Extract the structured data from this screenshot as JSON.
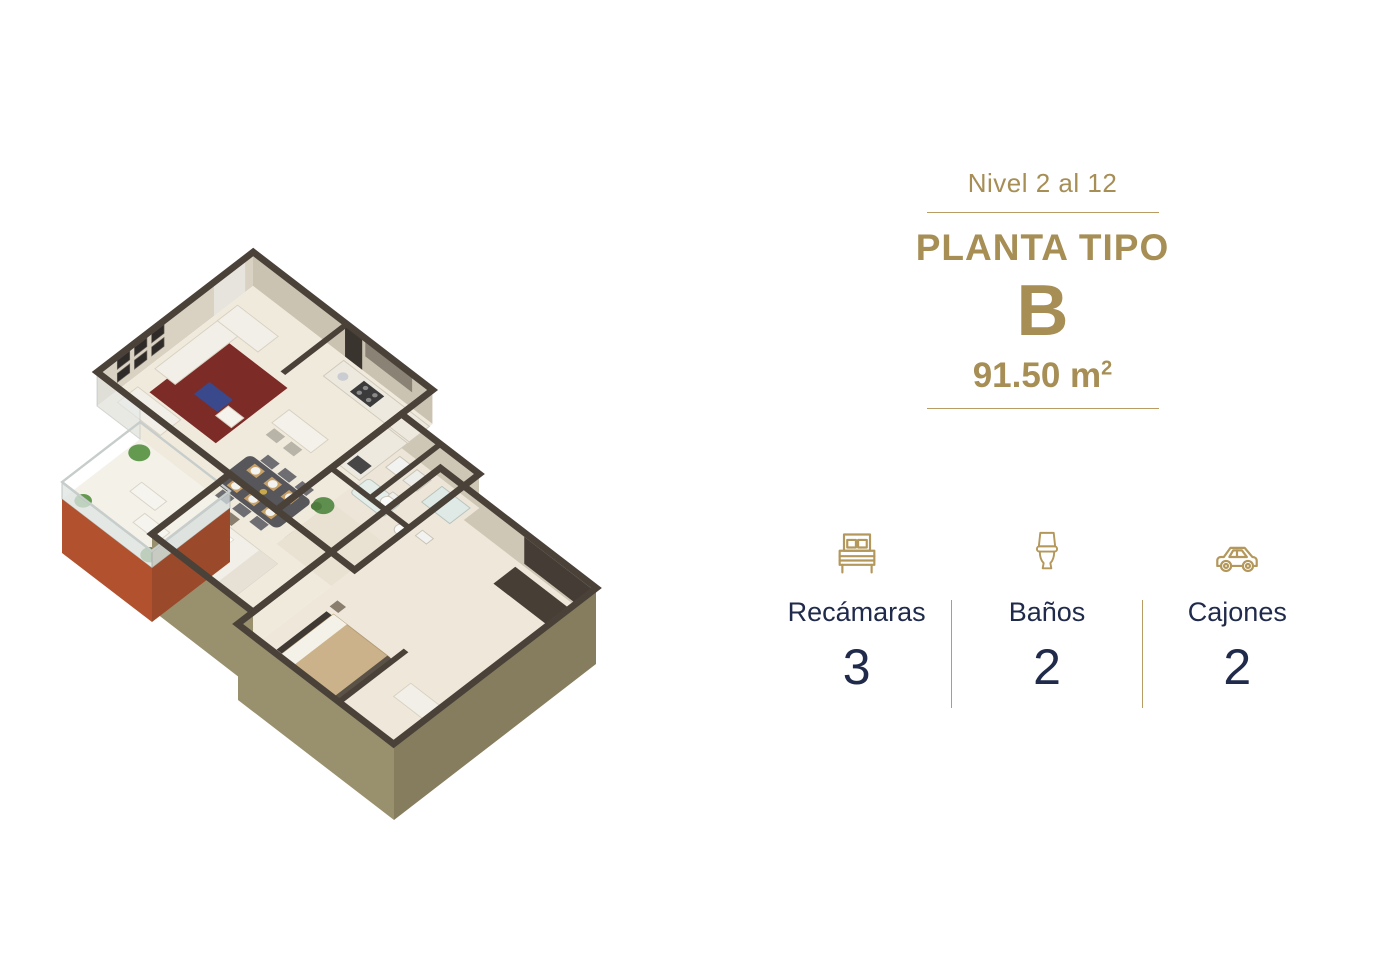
{
  "panel": {
    "level_label": "Nivel 2 al 12",
    "plan_type_label": "PLANTA TIPO",
    "plan_letter": "B",
    "area_text": "91.50 m",
    "area_superscript": "2",
    "accent_gold": "#A68E55",
    "divider_gold": "#B99C63",
    "text_navy": "#202B4B",
    "icon_gold": "#B4975A"
  },
  "stats": [
    {
      "icon": "bed-icon",
      "label": "Recámaras",
      "value": "3"
    },
    {
      "icon": "toilet-icon",
      "label": "Baños",
      "value": "2"
    },
    {
      "icon": "car-icon",
      "label": "Cajones",
      "value": "2"
    }
  ],
  "floorplan": {
    "kind": "isometric-3d-apartment-plan",
    "palette": {
      "wall_cap": "#4A4139",
      "interior_wall": "#D9D2C2",
      "exterior_khaki": "#99906E",
      "exterior_khaki_dark": "#867D5F",
      "floor_cream": "#F0EADD",
      "balcony_terracotta": "#B2512E",
      "balcony_terracotta_dark": "#9A4A2B",
      "rug_red": "#7D2B27",
      "ottoman_blue": "#39498C",
      "bed_tan": "#CBB28A",
      "plant_green": "#639A50",
      "furniture_white": "#F2EFE8"
    }
  }
}
